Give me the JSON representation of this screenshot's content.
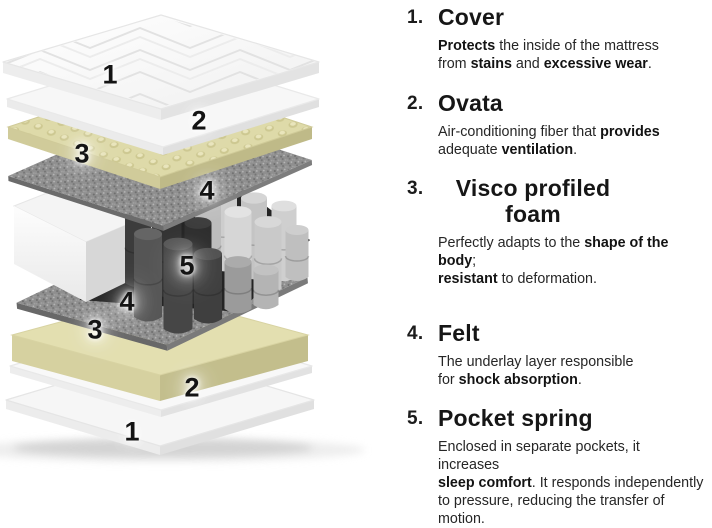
{
  "diagram": {
    "description": "Exploded view of mattress layers",
    "labels": [
      {
        "text": "1",
        "x": 110,
        "y": 75
      },
      {
        "text": "2",
        "x": 199,
        "y": 121
      },
      {
        "text": "3",
        "x": 82,
        "y": 154
      },
      {
        "text": "4",
        "x": 207,
        "y": 191
      },
      {
        "text": "5",
        "x": 187,
        "y": 266
      },
      {
        "text": "4",
        "x": 127,
        "y": 302
      },
      {
        "text": "3",
        "x": 95,
        "y": 330
      },
      {
        "text": "2",
        "x": 192,
        "y": 388
      },
      {
        "text": "1",
        "x": 132,
        "y": 432
      }
    ],
    "colors": {
      "foam_yellow": "#e0dcab",
      "felt_gray": "#8f8f8f",
      "spring_dark": "#454545",
      "spring_light": "#cfcfcf",
      "cover_white": "#f9f9f9",
      "label_text": "#141414"
    }
  },
  "info_list": {
    "items": [
      {
        "number": "1.",
        "title": "Cover",
        "description": [
          {
            "text": "Protects",
            "bold": true
          },
          {
            "text": " the inside of the mattress",
            "bold": false
          },
          {
            "br": true
          },
          {
            "text": "from ",
            "bold": false
          },
          {
            "text": "stains",
            "bold": true
          },
          {
            "text": " and ",
            "bold": false
          },
          {
            "text": "excessive wear",
            "bold": true
          },
          {
            "text": ".",
            "bold": false
          }
        ]
      },
      {
        "number": "2.",
        "title": "Ovata",
        "description": [
          {
            "text": "Air-conditioning fiber that ",
            "bold": false
          },
          {
            "text": "provides",
            "bold": true
          },
          {
            "br": true
          },
          {
            "text": "adequate ",
            "bold": false
          },
          {
            "text": "ventilation",
            "bold": true
          },
          {
            "text": ".",
            "bold": false
          }
        ]
      },
      {
        "number": "3.",
        "title": "Visco profiled foam",
        "description": [
          {
            "text": "Perfectly adapts to the ",
            "bold": false
          },
          {
            "text": "shape of the body",
            "bold": true
          },
          {
            "text": ";",
            "bold": false
          },
          {
            "br": true
          },
          {
            "text": "resistant",
            "bold": true
          },
          {
            "text": " to deformation.",
            "bold": false
          }
        ]
      },
      {
        "number": "4.",
        "title": "Felt",
        "description": [
          {
            "text": "The underlay layer responsible",
            "bold": false
          },
          {
            "br": true
          },
          {
            "text": "for ",
            "bold": false
          },
          {
            "text": "shock absorption",
            "bold": true
          },
          {
            "text": ".",
            "bold": false
          }
        ]
      },
      {
        "number": "5.",
        "title": "Pocket spring",
        "description": [
          {
            "text": "Enclosed in separate pockets, it increases",
            "bold": false
          },
          {
            "br": true
          },
          {
            "text": "sleep comfort",
            "bold": true
          },
          {
            "text": ". It responds independently",
            "bold": false
          },
          {
            "br": true
          },
          {
            "text": "to pressure, reducing the transfer of motion.",
            "bold": false
          }
        ]
      }
    ]
  }
}
